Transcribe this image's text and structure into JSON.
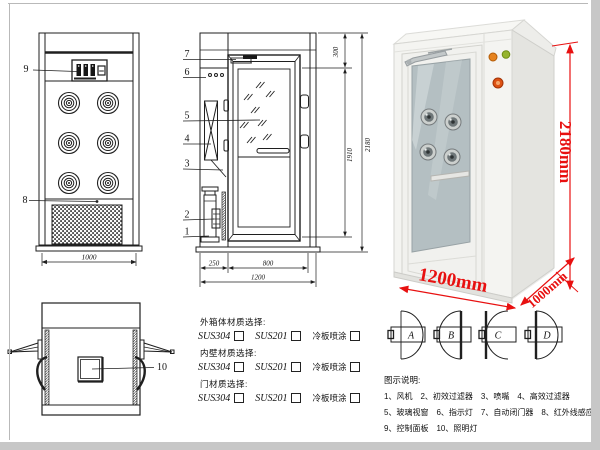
{
  "front_view": {
    "callout_9": "9",
    "callout_8": "8",
    "dim_width": "1000"
  },
  "side_view": {
    "callout_7": "7",
    "callout_6": "6",
    "callout_5": "5",
    "callout_4": "4",
    "callout_3": "3",
    "callout_2": "2",
    "callout_1": "1",
    "dim_top": "300",
    "dim_door_h": "1910",
    "dim_total_h": "2180",
    "dim_left": "250",
    "dim_door_w": "800",
    "dim_total_w": "1200"
  },
  "top_view": {
    "callout_10": "10"
  },
  "photo": {
    "dim_height": "2180mm",
    "dim_width": "1200mm",
    "dim_depth": "1000mm",
    "dim_color": "#e81010"
  },
  "door_options": {
    "a": "A",
    "b": "B",
    "c": "C",
    "d": "D"
  },
  "materials": {
    "groups": [
      {
        "label": "外箱体材质选择:",
        "opt1": "SUS304",
        "opt2": "SUS201",
        "opt3": "冷板喷涂"
      },
      {
        "label": "内壁材质选择:",
        "opt1": "SUS304",
        "opt2": "SUS201",
        "opt3": "冷板喷涂"
      },
      {
        "label": "门材质选择:",
        "opt1": "SUS304",
        "opt2": "SUS201",
        "opt3": "冷板喷涂"
      }
    ]
  },
  "legend": {
    "title": "图示说明:",
    "row1": [
      "1、风机",
      "2、初效过滤器",
      "3、喷嘴",
      "4、高效过滤器"
    ],
    "row2": [
      "5、玻璃视窗",
      "6、指示灯",
      "7、自动闭门器",
      "8、红外线感应器"
    ],
    "row3": [
      "9、控制面板",
      "10、照明灯"
    ]
  }
}
